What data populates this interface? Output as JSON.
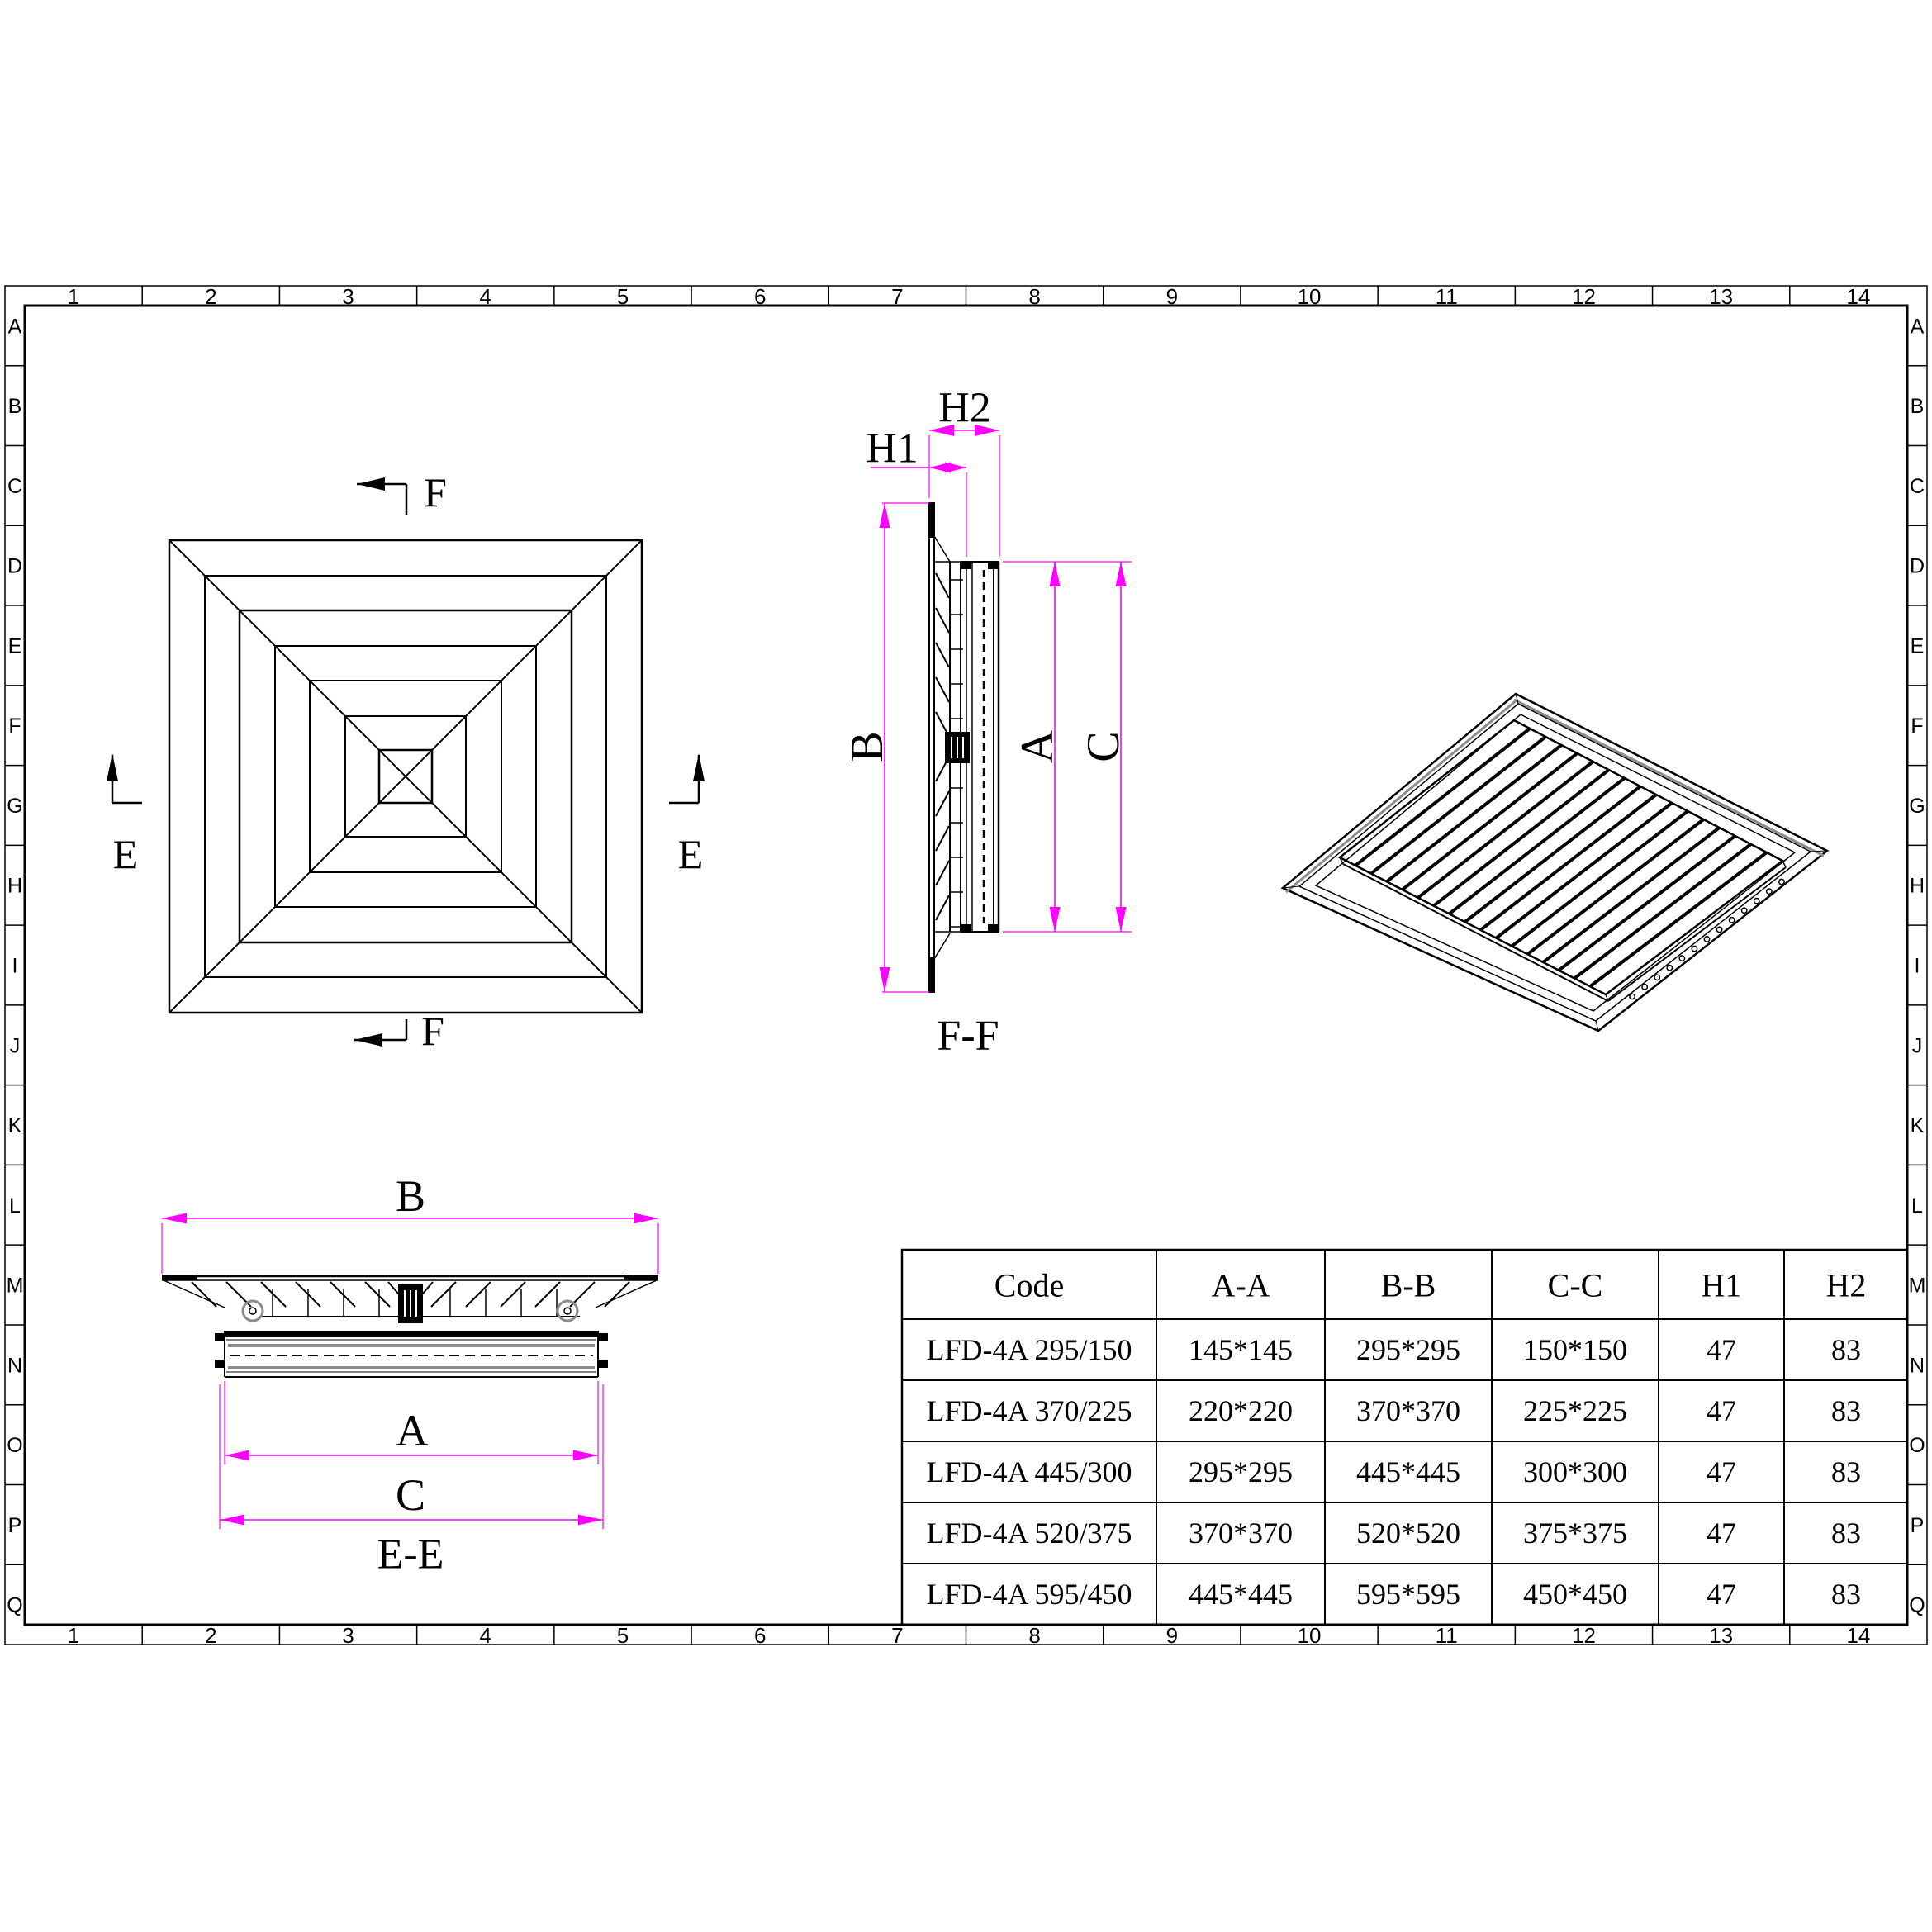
{
  "sheet": {
    "column_refs": [
      "1",
      "2",
      "3",
      "4",
      "5",
      "6",
      "7",
      "8",
      "9",
      "10",
      "11",
      "12",
      "13",
      "14"
    ],
    "row_refs": [
      "A",
      "B",
      "C",
      "D",
      "E",
      "F",
      "G",
      "H",
      "I",
      "J",
      "K",
      "L",
      "M",
      "N",
      "O",
      "P",
      "Q"
    ]
  },
  "labels": {
    "f_marker": "F",
    "e_marker": "E",
    "ff_section": "F-F",
    "ee_section": "E-E",
    "dim_a": "A",
    "dim_b": "B",
    "dim_c": "C",
    "dim_h1": "H1",
    "dim_h2": "H2"
  },
  "table": {
    "headers": [
      "Code",
      "A-A",
      "B-B",
      "C-C",
      "H1",
      "H2"
    ],
    "rows": [
      [
        "LFD-4A 295/150",
        "145*145",
        "295*295",
        "150*150",
        "47",
        "83"
      ],
      [
        "LFD-4A 370/225",
        "220*220",
        "370*370",
        "225*225",
        "47",
        "83"
      ],
      [
        "LFD-4A 445/300",
        "295*295",
        "445*445",
        "300*300",
        "47",
        "83"
      ],
      [
        "LFD-4A 520/375",
        "370*370",
        "520*520",
        "375*375",
        "47",
        "83"
      ],
      [
        "LFD-4A 595/450",
        "445*445",
        "595*595",
        "450*450",
        "47",
        "83"
      ]
    ]
  },
  "colors": {
    "line": "#000000",
    "dimension": "#ff00ff",
    "accent_gray": "#8c8c8c",
    "background": "#ffffff"
  }
}
